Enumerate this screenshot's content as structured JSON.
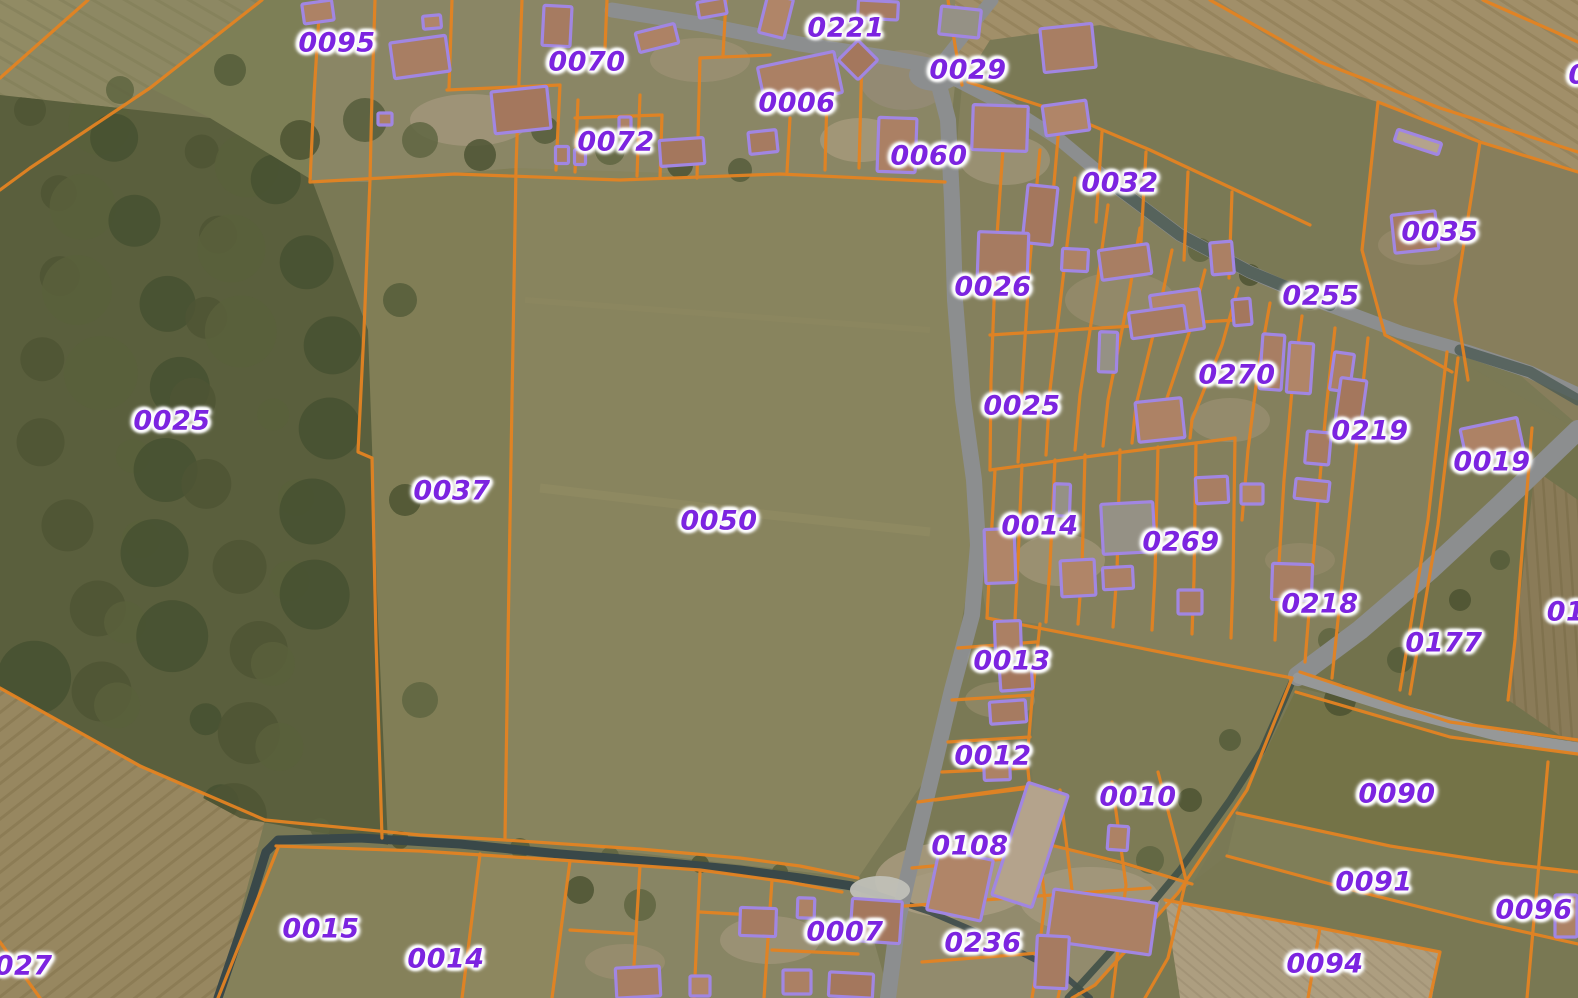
{
  "map": {
    "description": "Cadastral parcel map overlaid on aerial photography: orange parcel boundaries, purple building footprints, purple parcel-number labels",
    "colors": {
      "parcel_boundary": "#ec8520",
      "building_outline": "#a588ec",
      "parcel_label": "#7c24e0",
      "label_halo": "#ffffff",
      "road": "#8f9194",
      "water": "#37474a"
    },
    "parcel_labels": [
      {
        "text": "0095",
        "x": 337,
        "y": 43
      },
      {
        "text": "0070",
        "x": 587,
        "y": 62
      },
      {
        "text": "0221",
        "x": 846,
        "y": 28
      },
      {
        "text": "0029",
        "x": 968,
        "y": 70
      },
      {
        "text": "0006",
        "x": 797,
        "y": 103
      },
      {
        "text": "0072",
        "x": 616,
        "y": 142
      },
      {
        "text": "0060",
        "x": 929,
        "y": 156
      },
      {
        "text": "0032",
        "x": 1120,
        "y": 183
      },
      {
        "text": "0035",
        "x": 1440,
        "y": 232
      },
      {
        "text": "0026",
        "x": 993,
        "y": 287
      },
      {
        "text": "0255",
        "x": 1321,
        "y": 296
      },
      {
        "text": "0270",
        "x": 1237,
        "y": 375
      },
      {
        "text": "0025",
        "x": 1022,
        "y": 406
      },
      {
        "text": "0025",
        "x": 172,
        "y": 421
      },
      {
        "text": "0219",
        "x": 1370,
        "y": 431
      },
      {
        "text": "0019",
        "x": 1492,
        "y": 462
      },
      {
        "text": "0037",
        "x": 452,
        "y": 491
      },
      {
        "text": "0050",
        "x": 719,
        "y": 521
      },
      {
        "text": "0014",
        "x": 1040,
        "y": 526
      },
      {
        "text": "0269",
        "x": 1181,
        "y": 542
      },
      {
        "text": "0218",
        "x": 1320,
        "y": 604
      },
      {
        "text": "01",
        "x": 1566,
        "y": 612,
        "partial": true
      },
      {
        "text": "0177",
        "x": 1444,
        "y": 643
      },
      {
        "text": "0013",
        "x": 1012,
        "y": 661
      },
      {
        "text": "0012",
        "x": 993,
        "y": 756
      },
      {
        "text": "0090",
        "x": 1397,
        "y": 794
      },
      {
        "text": "0010",
        "x": 1138,
        "y": 797
      },
      {
        "text": "0108",
        "x": 970,
        "y": 846
      },
      {
        "text": "0091",
        "x": 1374,
        "y": 882
      },
      {
        "text": "0096",
        "x": 1534,
        "y": 910
      },
      {
        "text": "0015",
        "x": 321,
        "y": 929
      },
      {
        "text": "0007",
        "x": 845,
        "y": 932
      },
      {
        "text": "0236",
        "x": 983,
        "y": 943
      },
      {
        "text": "0014",
        "x": 446,
        "y": 959
      },
      {
        "text": "0094",
        "x": 1325,
        "y": 964
      },
      {
        "text": "0027",
        "x": 14,
        "y": 966,
        "partial": true
      },
      {
        "text": "0",
        "x": 1578,
        "y": 75,
        "partial": true
      }
    ]
  }
}
